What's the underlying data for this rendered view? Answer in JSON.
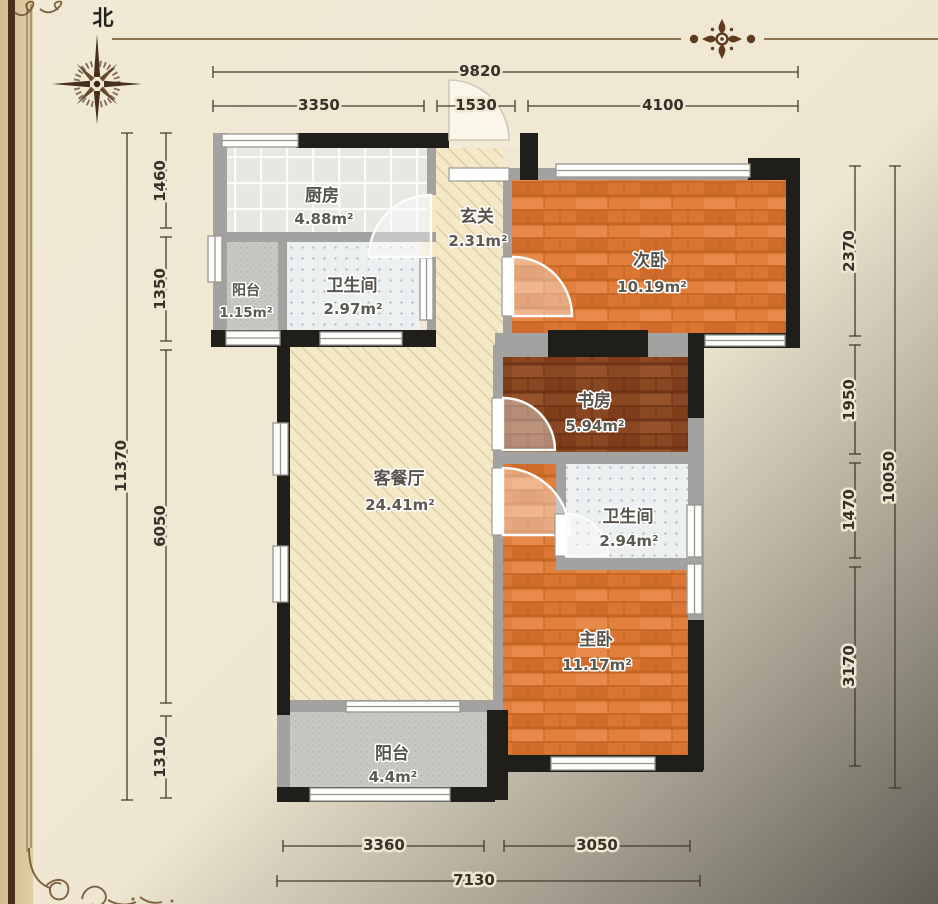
{
  "compass": {
    "north_label": "北"
  },
  "rooms": {
    "kitchen": {
      "name": "厨房",
      "area": "4.88m²"
    },
    "balcony_top": {
      "name": "阳台",
      "area": "1.15m²"
    },
    "bath_top": {
      "name": "卫生间",
      "area": "2.97m²"
    },
    "entry": {
      "name": "玄关",
      "area": "2.31m²"
    },
    "bedroom_second": {
      "name": "次卧",
      "area": "10.19m²"
    },
    "study": {
      "name": "书房",
      "area": "5.94m²"
    },
    "bath_mid": {
      "name": "卫生间",
      "area": "2.94m²"
    },
    "living_dining": {
      "name": "客餐厅",
      "area": "24.41m²"
    },
    "bedroom_master": {
      "name": "主卧",
      "area": "11.17m²"
    },
    "balcony_bottom": {
      "name": "阳台",
      "area": "4.4m²"
    }
  },
  "dimensions": {
    "top": {
      "total": "9820",
      "segments": [
        "3350",
        "1530",
        "4100"
      ]
    },
    "left": {
      "total": "11370",
      "segments": [
        "1460",
        "1350",
        "6050",
        "1310"
      ]
    },
    "right": {
      "total": "10050",
      "segments": [
        "2370",
        "1950",
        "1470",
        "3170"
      ]
    },
    "bottom": {
      "total": "7130",
      "segments": [
        "3360",
        "3050"
      ]
    }
  },
  "colors": {
    "paper": "#efe7d1",
    "frame_band": "#d8c59b",
    "frame_line": "#4c2f1a",
    "wall_exterior": "#201e1b",
    "wall_interior": "#a3a2a0",
    "wood_floor": "#e08040",
    "wood_dark_floor": "#8c4a24",
    "hatch_floor": "#f4e8c7",
    "tile_floor": "#e7e7e4",
    "balcony_floor": "#c9c7c3",
    "dimension_text": "#36312a"
  }
}
